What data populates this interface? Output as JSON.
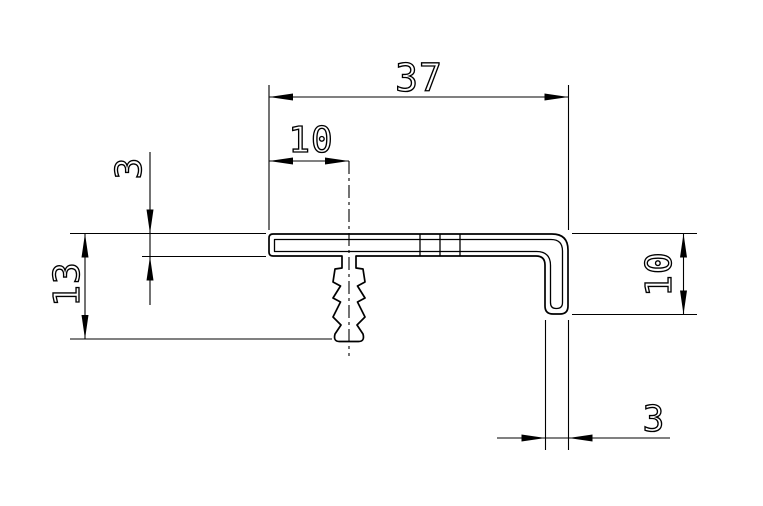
{
  "drawing": {
    "type": "technical-cross-section",
    "description_of_part": "L-shaped edge profile with barbed push-in fastener",
    "dimension_labels": {
      "overall_width": "37",
      "fastener_center_offset": "10",
      "flange_thickness": "3",
      "overall_depth": "13",
      "leg_height": "10",
      "leg_thickness": "3"
    },
    "colors": {
      "background": "#ffffff",
      "lines": "#000000"
    }
  }
}
